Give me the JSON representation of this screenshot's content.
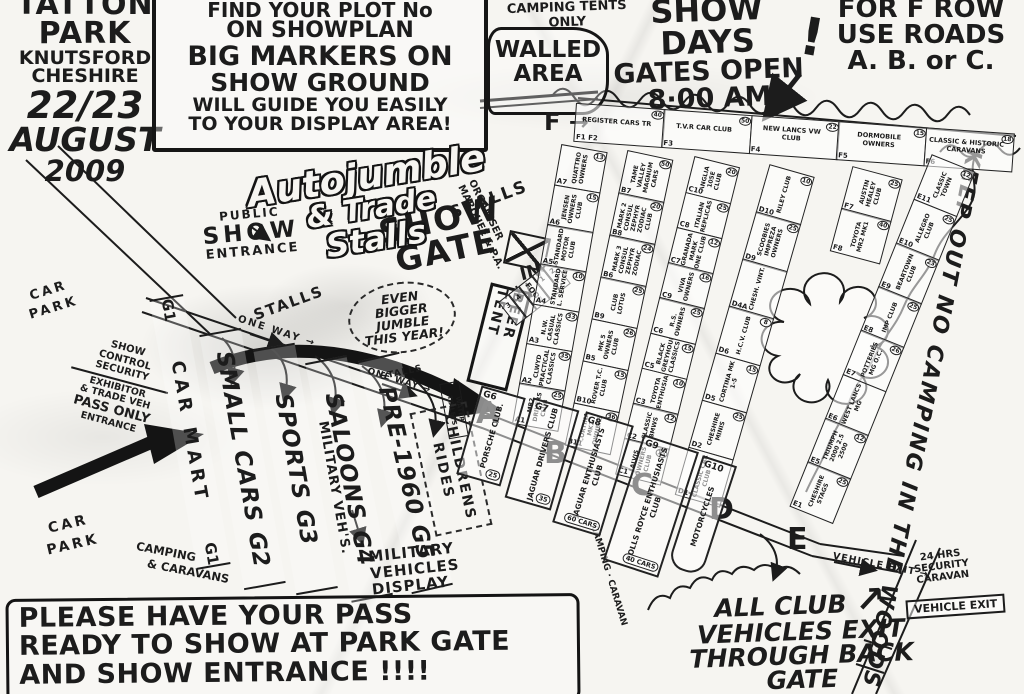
{
  "colors": {
    "ink": "#1c1c1c",
    "paper": "#f6f5f1"
  },
  "title": {
    "l1": "TATTON",
    "l2": "PARK",
    "l3": "KNUTSFORD",
    "l4": "CHESHIRE",
    "l5": "22/23",
    "l6": "AUGUST",
    "l7": "2009"
  },
  "notice": {
    "l1": "FIND YOUR PLOT No",
    "l2": "ON SHOWPLAN",
    "l3": "BIG MARKERS ON",
    "l4": "SHOW GROUND",
    "l5": "WILL GUIDE YOU EASILY",
    "l6": "TO YOUR DISPLAY AREA!"
  },
  "top": {
    "camping_tents": "CAMPING TENTS ONLY",
    "walled_l1": "WALLED",
    "walled_l2": "AREA",
    "show_days_l1": "SHOW DAYS",
    "show_days_l2": "GATES OPEN",
    "show_days_l3": "8·00 AM",
    "bang": "!",
    "f_note_l1": "FOR F ROW",
    "f_note_l2": "USE ROADS",
    "f_note_l3": "A. B. or C."
  },
  "right_side": {
    "keep_out": "KEEP OUT NO CAMPING IN THE WOODS !",
    "security_l1": "24 HRS",
    "security_l2": "SECURITY",
    "security_l3": "CARAVAN",
    "vehicle_exit_sign": "VEHICLE EXIT",
    "vehicle_exit_road": "VEHICLE EXIT →"
  },
  "left_side": {
    "public_l1": "PUBLIC",
    "public_l2": "SHOW",
    "public_l3": "ENTRANCE",
    "show_gate_l1": "SHOW",
    "show_gate_l2": "GATE",
    "show_gate_in": "IN",
    "car_park_l1": "CAR",
    "car_park_l2": "PARK",
    "control_l1": "SHOW",
    "control_l2": "CONTROL",
    "control_l3": "SECURITY",
    "exhibitor_l1": "EXHIBITOR",
    "exhibitor_l2": "& TRADE VEH",
    "exhibitor_l3": "PASS ONLY",
    "exhibitor_l4": "ENTRANCE",
    "camping_l1": "CAMPING",
    "camping_l2": "& CARAVANS"
  },
  "center": {
    "autojumble_l1": "Autojumble",
    "autojumble_l2": "& Trade",
    "autojumble_l3": "Stalls",
    "stalls": "STALLS",
    "jumble_l1": "EVEN",
    "jumble_l2": "BIGGER",
    "jumble_l3": "JUMBLE",
    "jumble_l4": "THIS YEAR!",
    "one_way": "ONE WAY →",
    "organiser_l1": "ORGANISER",
    "organiser_l2": "MARQUEE & P.A.",
    "beer_tent": "BEER TENT",
    "food": "FOOD",
    "food_cells": [
      "3",
      "4",
      "1",
      "2"
    ],
    "water_toilets": "WATER TOILETS",
    "childrens_l1": "CHILDRENS",
    "childrens_l2": "RIDES",
    "military_short": "MILITARY VEH'S.",
    "military_l1": "MILITARY",
    "military_l2": "VEHICLES",
    "military_l3": "DISPLAY",
    "camping_mid": "CAMPING · CARAVAN"
  },
  "lanes": [
    {
      "id": "G1",
      "label": "CAR MART"
    },
    {
      "id": "G2",
      "label": "SMALL CARS"
    },
    {
      "id": "G3",
      "label": "SPORTS"
    },
    {
      "id": "G4",
      "label": "SALOONS"
    },
    {
      "id": "G5",
      "label": "PRE-1960"
    }
  ],
  "grid": {
    "f_marker": "F →",
    "road_letters": [
      "A",
      "B",
      "C",
      "D",
      "E"
    ],
    "f_row": [
      {
        "id": "F1 F2",
        "name": "REGISTER CARS TR",
        "count": "40"
      },
      {
        "id": "F3",
        "name": "T.V.R CAR CLUB",
        "count": "50"
      },
      {
        "id": "F4",
        "name": "NEW LANCS VW CLUB",
        "count": "22"
      },
      {
        "id": "F5",
        "name": "DORMOBILE OWNERS",
        "count": "15"
      },
      {
        "id": "F6",
        "name": "CLASSIC & HISTORIC CARAVANS",
        "count": "18"
      }
    ],
    "f_extra": [
      {
        "id": "F7",
        "name": "AUSTIN HEALEY CLUB",
        "count": "25"
      },
      {
        "id": "F8",
        "name": "TOYOTA MR2 MK1",
        "count": "40"
      }
    ],
    "col_a": [
      {
        "id": "A7",
        "name": "QUATTRO OWNERS",
        "count": "13"
      },
      {
        "id": "A6",
        "name": "JENSEN OWNERS CLUB",
        "count": "15"
      },
      {
        "id": "A5",
        "name": "STANDARD MOTOR CLUB",
        "count": ""
      },
      {
        "id": "A4",
        "name": "STANDARD L. SERVICE",
        "count": "10"
      },
      {
        "id": "A3",
        "name": "N.W. CASUAL CLASSICS",
        "count": "33"
      },
      {
        "id": "A2",
        "name": "CLWYD PRACTICAL CLASSICS",
        "count": "35"
      },
      {
        "id": "A1",
        "name": "MR2 DRIVERS CLUB",
        "count": "25"
      }
    ],
    "col_b": [
      {
        "id": "B7",
        "name": "TAME VALLEY MAGNUM CARS",
        "count": "50"
      },
      {
        "id": "B8",
        "name": "MARK 2 CONSUL ZEPHYR ZODIAC CLUB",
        "count": "20"
      },
      {
        "id": "B6",
        "name": "MARK 3 CONSUL ZEPHYR ZODIAC",
        "count": "24"
      },
      {
        "id": "B9",
        "name": "CLUB LOTUS",
        "count": "25"
      },
      {
        "id": "B5",
        "name": "MK 5 OWNERS CLUB",
        "count": "26"
      },
      {
        "id": "B10",
        "name": "ROVER T.C. CLUB",
        "count": "15"
      },
      {
        "id": "B11",
        "name": "CORTINA MK2 OWNERS",
        "count": "36"
      }
    ],
    "col_c": [
      {
        "id": "C10",
        "name": "ANGLIA 105E CLUB",
        "count": "20"
      },
      {
        "id": "C8",
        "name": "ITALIAN REPLICAS",
        "count": "25"
      },
      {
        "id": "C7",
        "name": "GRANADA MARK ONE CLUB",
        "count": "12"
      },
      {
        "id": "C9",
        "name": "VIVA OWNERS",
        "count": "16"
      },
      {
        "id": "C6",
        "name": "R.S. OWNERS",
        "count": "25"
      },
      {
        "id": "C5",
        "name": "BLACK GREYHOUND CLASSICS",
        "count": "15"
      },
      {
        "id": "C3",
        "name": "TOYOTA ENTHUSIASTS",
        "count": "10"
      },
      {
        "id": "C2",
        "name": "CLASSIC BMWS",
        "count": "12"
      },
      {
        "id": "C1",
        "name": "ALVIS OWNERS CLUB",
        "count": "15"
      }
    ],
    "col_d": [
      {
        "id": "D10",
        "name": "RILEY CLUB",
        "count": "10"
      },
      {
        "id": "D9",
        "name": "SCOOBIES IMPREZA OWNERS",
        "count": "25"
      },
      {
        "id": "D4A",
        "name": "CHESH. VINT.",
        "count": ""
      },
      {
        "id": "D6",
        "name": "H.C.V. CLUB",
        "count": "8"
      },
      {
        "id": "D5",
        "name": "CORTINA MK 1-5",
        "count": "15"
      },
      {
        "id": "D2",
        "name": "CHESHIRE MINIS",
        "count": "25"
      },
      {
        "id": "D1",
        "name": "CLASSIC CAR CLUB",
        "count": ""
      }
    ],
    "col_e": [
      {
        "id": "E11",
        "name": "CLASSIC TOWN",
        "count": "12"
      },
      {
        "id": "E10",
        "name": "ALLEGRO CLUB",
        "count": "25"
      },
      {
        "id": "E9",
        "name": "BEARTOWN CLUB",
        "count": "23"
      },
      {
        "id": "E8",
        "name": "IMP CLUB",
        "count": "25"
      },
      {
        "id": "E7",
        "name": "POTTERIES MG O.C.",
        "count": "26"
      },
      {
        "id": "E6",
        "name": "WEST LANCS MG",
        "count": ""
      },
      {
        "id": "E5",
        "name": "TRIUMPH 2000 2.5 2500",
        "count": "12"
      },
      {
        "id": "E1",
        "name": "CHESHIRE STAGS",
        "count": "25"
      }
    ],
    "g_plots": [
      {
        "id": "G6",
        "name": "PORSCHE CLUB.",
        "count": "25"
      },
      {
        "id": "G7",
        "name": "JAGUAR DRIVERS CLUB",
        "count": "35"
      },
      {
        "id": "G8",
        "name": "JAGUAR ENTHUSIASTS CLUB",
        "count": "60 CARS"
      },
      {
        "id": "G9",
        "name": "ROLLS ROYCE ENTHUSIASTS CLUB",
        "count": "40 CARS"
      },
      {
        "id": "G10",
        "name": "MOTORCYCLES",
        "count": ""
      }
    ]
  },
  "bottom": {
    "pass_l1": "PLEASE HAVE YOUR PASS",
    "pass_l2": "READY TO SHOW AT PARK GATE",
    "pass_l3": "AND SHOW ENTRANCE !!!!",
    "exit_l1": "ALL CLUB",
    "exit_arrow": "↗",
    "exit_l2": "VEHICLES EXIT",
    "exit_l3": "THROUGH BACK",
    "exit_l4": "GATE"
  }
}
